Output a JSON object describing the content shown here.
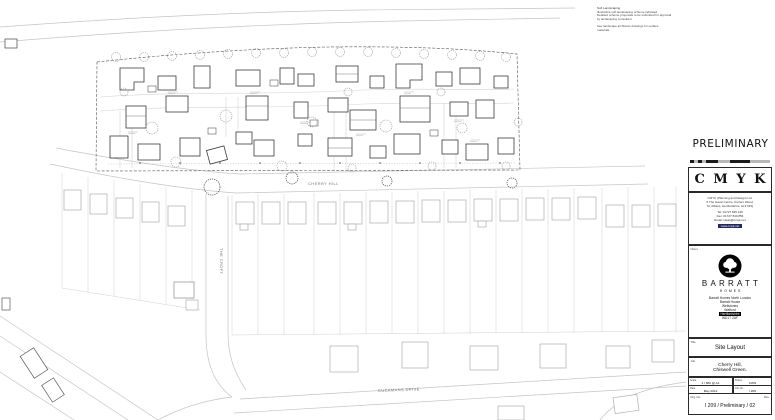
{
  "notes": {
    "landscaping": [
      "Soft Landscaping",
      "Illustrative soft landscaping scheme indicated.",
      "Detailed scheme proposals to be submitted for approval",
      "by landscaping consultant."
    ],
    "materials": [
      "See landscape architects drawings for surface",
      "materials."
    ]
  },
  "plan": {
    "streets": {
      "cherry_hill": "CHERRY HILL",
      "the_croft": "THE CROFT",
      "cuckmans_drive": "CUCKMANS DRIVE"
    }
  },
  "title_block": {
    "status": "PRELIMINARY",
    "logo_letters": "C M Y K",
    "consultant": {
      "line1": "CMYK (Planning and Design) Ltd.",
      "line2": "6 The Gavel Centre, Porters Wood,",
      "line3": "St. Albans, Hertfordshire, AL3 6PQ",
      "tel": "Tel:  01727 845 145",
      "fax": "Fax:  01727 840 856",
      "email": "Email:  ideas@cmyk.net",
      "web": "www.cmyk.net"
    },
    "client_label": "Client",
    "client": {
      "brand": "BARRATT",
      "brand_sub": "HOMES",
      "address": [
        "Barratt Homes North London",
        "Barratt House",
        "Wellstones",
        "Watford",
        "Hertfordshire",
        "WD17 2AF"
      ]
    },
    "title_label": "Title",
    "title_value": "Site Layout",
    "job_label": "Job",
    "job_line1": "Cherry Hill,",
    "job_line2": "Chiswell Green.",
    "fields": {
      "scale_label": "Scale",
      "scale_value": "1 / 500 @ A1",
      "drawn_label": "Drawn",
      "drawn_value": "CWN",
      "date_label": "Date",
      "date_value": "May 2012",
      "job_no_label": "Job No.",
      "job_no_value": "I 209"
    },
    "drg_label": "Drg. No.",
    "rev_label": "Rev.",
    "drg_value": "I 209 / Preliminary / 02"
  }
}
